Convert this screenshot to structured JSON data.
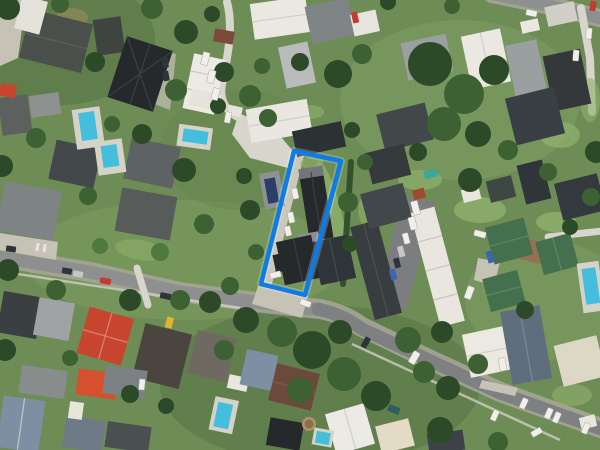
{
  "canvas": {
    "width": 600,
    "height": 450
  },
  "scene": {
    "type": "aerial-imagery",
    "subject": "suburban residential neighbourhood with a highlighted property parcel"
  },
  "parcel": {
    "points": "294,151 341,161 305,295 261,284",
    "stroke_width": 4.5
  },
  "palette": {
    "parcel_outline": "#0c7ce8",
    "grass_base": "#6e8c56",
    "grass_light": "#8fb06c",
    "grass_dark": "#4b6a3e",
    "tree_dark": "#2c4a28",
    "tree_mid": "#3d6132",
    "tree_light": "#4e7a42",
    "road_asphalt": "#8e8f8f",
    "road_asphalt_dark": "#7e8081",
    "road_verge": "#a9a79a",
    "footpath": "#d6d3c8",
    "concrete": "#d8d5cc",
    "paving": "#c6c2b6",
    "driveway_asphalt": "#7b7d7f",
    "court_brick": "#9a6a50",
    "roof_charcoal": "#26292c",
    "roof_white": "#eae8e1",
    "roof_red": "#c7452f",
    "roof_red_orange": "#d4502f",
    "roof_green": "#44704e",
    "roof_slate": "#5f6e7c",
    "roof_blue_gray": "#7d8fa2",
    "roof_brown": "#6b4a3c",
    "solar_panel": "#2b3f66",
    "pool_water": "#45bede",
    "pool_deck": "#d5d2c8",
    "car_white": "#f0efea",
    "car_dark": "#2f3439",
    "car_red": "#c33b2e",
    "car_blue": "#3a68b0",
    "car_teal": "#2e5f5f",
    "car_yellow": "#e0b52e"
  }
}
